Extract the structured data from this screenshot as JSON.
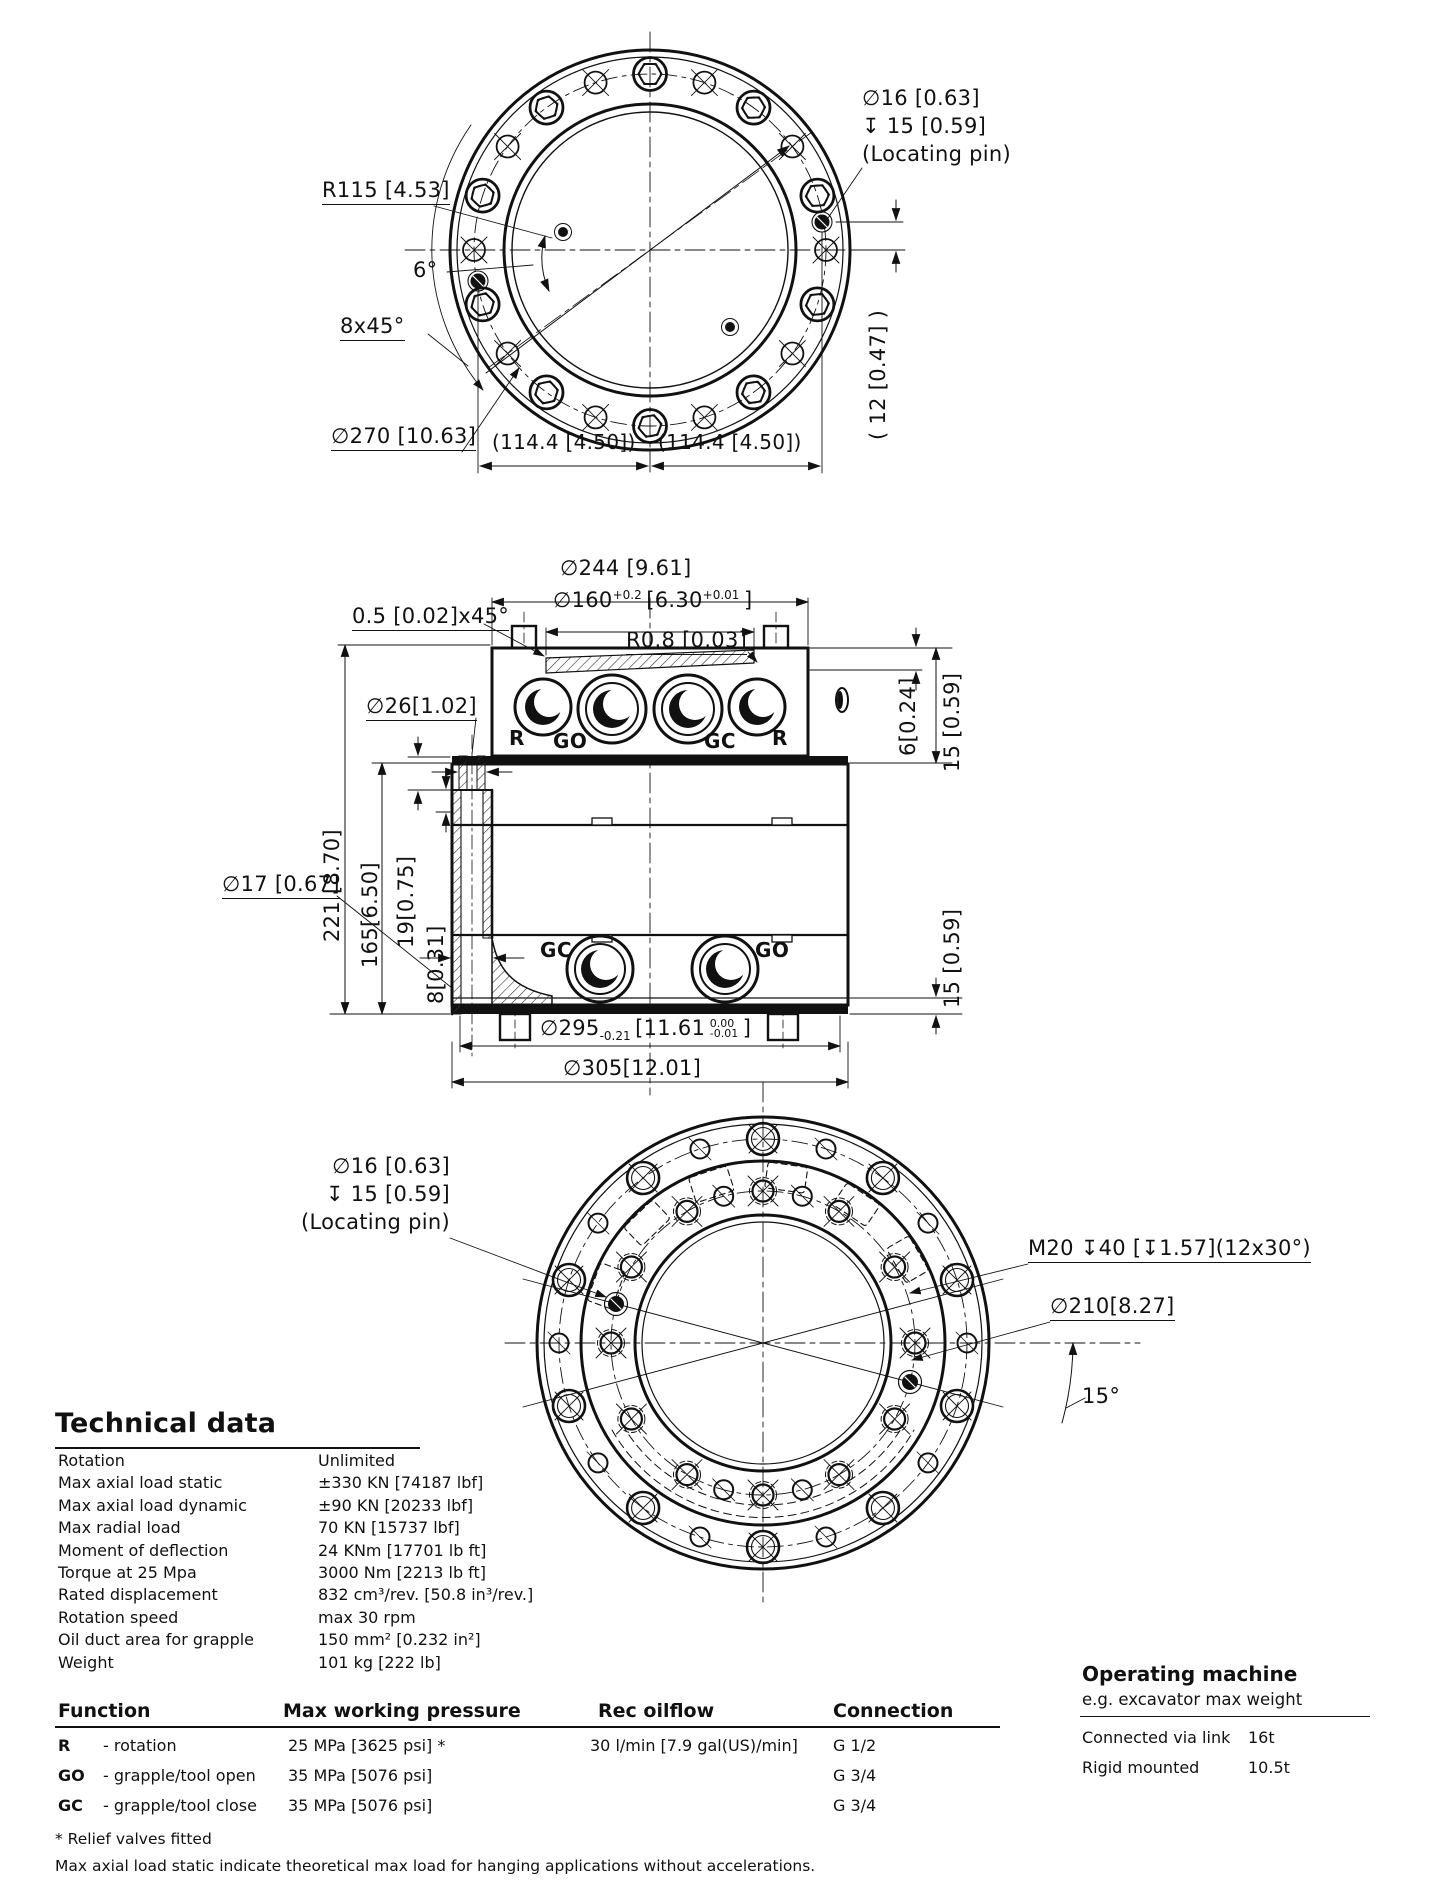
{
  "locating_pin": {
    "dia": "∅16 [0.63]",
    "depth": "↧ 15 [0.59]",
    "note": "(Locating pin)"
  },
  "top_view": {
    "radius_dim": "R115 [4.53]",
    "angle_6": "6°",
    "chamfer": "8x45°",
    "bolt_circle_dia": "∅270 [10.63]",
    "pin_offset": "(114.4 [4.50])",
    "pin_height": "( 12 [0.47] )"
  },
  "side_view": {
    "dia_244": "∅244 [9.61]",
    "dia_160": {
      "main": "∅160",
      "tol_mm": "+0.2",
      "inch": "[6.30",
      "tol_in": "+0.01",
      "close": "]"
    },
    "chamfer_05": "0.5 [0.02]x45°",
    "radius_08": "R0.8 [0.03]",
    "dia_26": "∅26[1.02]",
    "height_221": "221 [8.70]",
    "height_165": "165[6.50]",
    "height_19": "19[0.75]",
    "height_8": "8[0.31]",
    "dia_17": "∅17 [0.67]",
    "dia_295": {
      "main": "∅295",
      "tol_mm": "-0.21",
      "inch": "[11.61",
      "tol_hi": "0.00",
      "tol_lo": "-0.01",
      "close": "]"
    },
    "dia_305": "∅305[12.01]",
    "step_6": "6[0.24]",
    "step_15": "15 [0.59]",
    "ports_top": [
      "R",
      "GO",
      "GC",
      "R"
    ],
    "ports_bottom": [
      "GC",
      "GO"
    ]
  },
  "bottom_view": {
    "thread": "M20 ↧40 [↧1.57](12x30°)",
    "dia_210": "∅210[8.27]",
    "angle_15": "15°"
  },
  "technical_data": {
    "heading": "Technical data",
    "rows": [
      {
        "label": "Rotation",
        "value": "Unlimited"
      },
      {
        "label": "Max axial load static",
        "value": "±330 KN [74187 lbf]"
      },
      {
        "label": "Max axial load dynamic",
        "value": "±90 KN [20233 lbf]"
      },
      {
        "label": "Max radial load",
        "value": "70 KN [15737 lbf]"
      },
      {
        "label": "Moment of deflection",
        "value": "24 KNm [17701 lb ft]"
      },
      {
        "label": "Torque at 25 Mpa",
        "value": "3000 Nm [2213 lb ft]"
      },
      {
        "label": "Rated displacement",
        "value": "832 cm³/rev. [50.8 in³/rev.]"
      },
      {
        "label": "Rotation speed",
        "value": "max 30 rpm"
      },
      {
        "label": "Oil duct area for grapple",
        "value": "150 mm² [0.232 in²]"
      },
      {
        "label": "Weight",
        "value": "101 kg [222 lb]"
      }
    ]
  },
  "function_table": {
    "headers": [
      "Function",
      "Max working pressure",
      "Rec oilflow",
      "Connection"
    ],
    "rows": [
      {
        "code": "R",
        "desc": "- rotation",
        "pressure": "25 MPa [3625 psi] *",
        "oilflow": "30 l/min [7.9 gal(US)/min]",
        "connection": "G 1/2"
      },
      {
        "code": "GO",
        "desc": "- grapple/tool open",
        "pressure": "35 MPa [5076 psi]",
        "oilflow": "",
        "connection": "G 3/4"
      },
      {
        "code": "GC",
        "desc": "- grapple/tool close",
        "pressure": "35 MPa [5076 psi]",
        "oilflow": "",
        "connection": "G 3/4"
      }
    ],
    "footnote_1": "* Relief valves fitted",
    "footnote_2": "Max axial load static indicate theoretical max load for hanging applications without accelerations."
  },
  "operating_machine": {
    "heading": "Operating machine",
    "subheading": "e.g. excavator max weight",
    "rows": [
      {
        "label": "Connected via link",
        "value": "16t"
      },
      {
        "label": "Rigid mounted",
        "value": "10.5t"
      }
    ]
  }
}
